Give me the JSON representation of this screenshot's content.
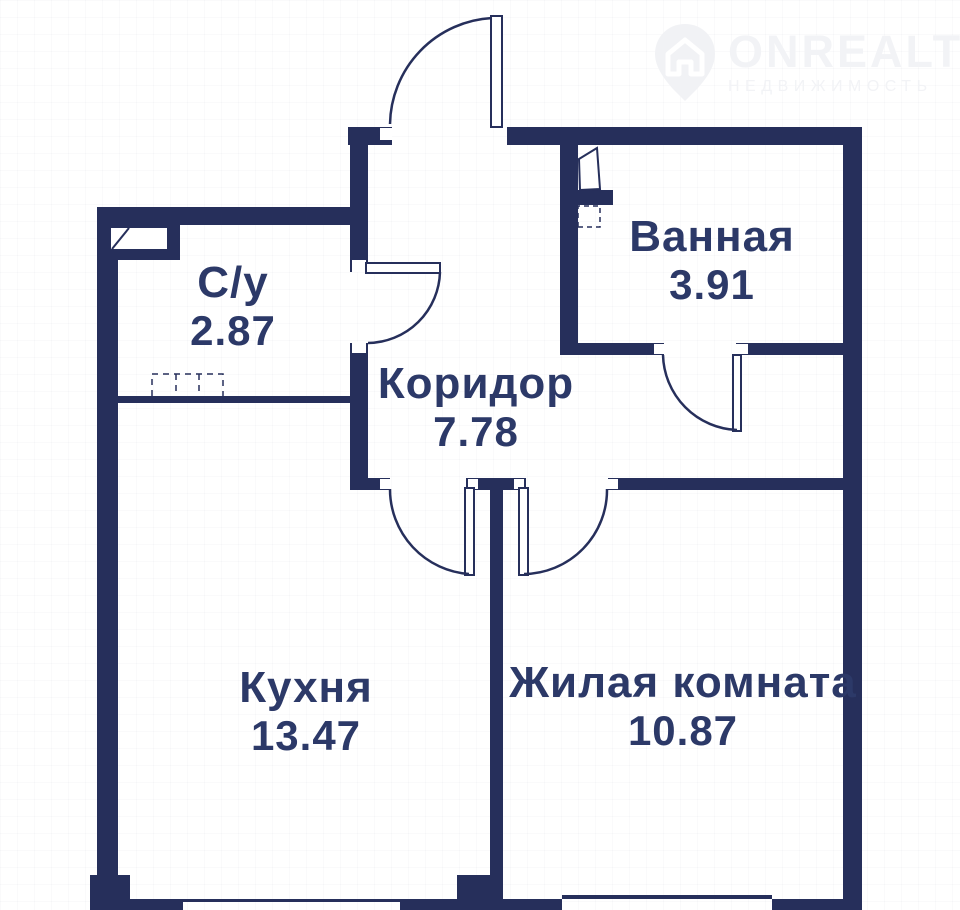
{
  "watermark": {
    "brand": "ONREALT",
    "tagline": "НЕДВИЖИМОСТЬ",
    "icon": "house-location-pin-icon",
    "color": "#f2f3f6"
  },
  "floor_plan": {
    "rooms": [
      {
        "id": "su",
        "name": "С/у",
        "area": "2.87"
      },
      {
        "id": "bathroom",
        "name": "Ванная",
        "area": "3.91"
      },
      {
        "id": "corridor",
        "name": "Коридор",
        "area": "7.78"
      },
      {
        "id": "kitchen",
        "name": "Кухня",
        "area": "13.47"
      },
      {
        "id": "living",
        "name": "Жилая комната",
        "area": "10.87"
      }
    ],
    "colors": {
      "wall": "#262f5b",
      "label_text": "#2c3968",
      "background": "#ffffff"
    }
  }
}
